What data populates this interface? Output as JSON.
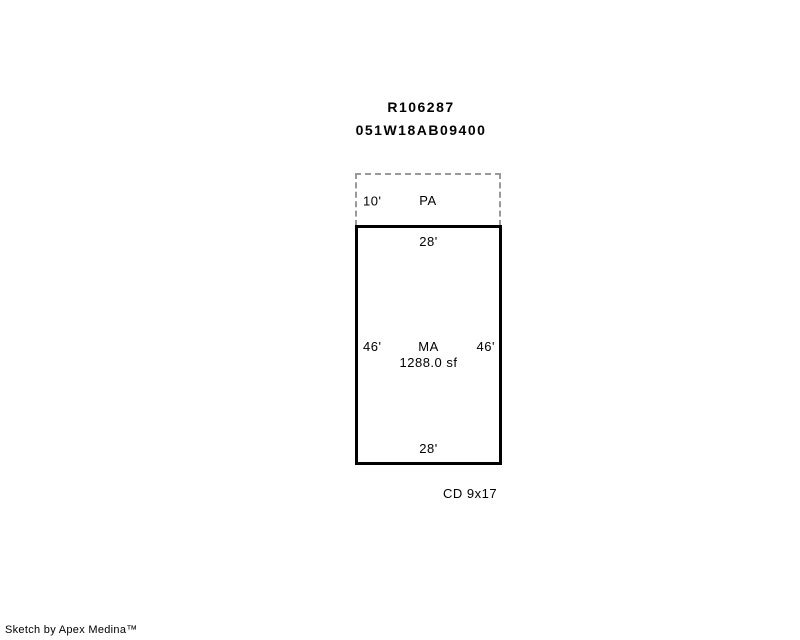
{
  "header": {
    "record_id": "R106287",
    "parcel_id": "051W18AB09400"
  },
  "sketch": {
    "pa": {
      "label": "PA",
      "left_dim": "10'"
    },
    "ma": {
      "label": "MA",
      "area": "1288.0 sf",
      "top_dim": "28'",
      "bottom_dim": "28'",
      "left_dim": "46'",
      "right_dim": "46'"
    },
    "cd_label": "CD 9x17"
  },
  "footer": {
    "credit": "Sketch by Apex Medina™"
  },
  "colors": {
    "background": "#ffffff",
    "line": "#000000",
    "dashed-line": "#999999",
    "text": "#000000"
  }
}
